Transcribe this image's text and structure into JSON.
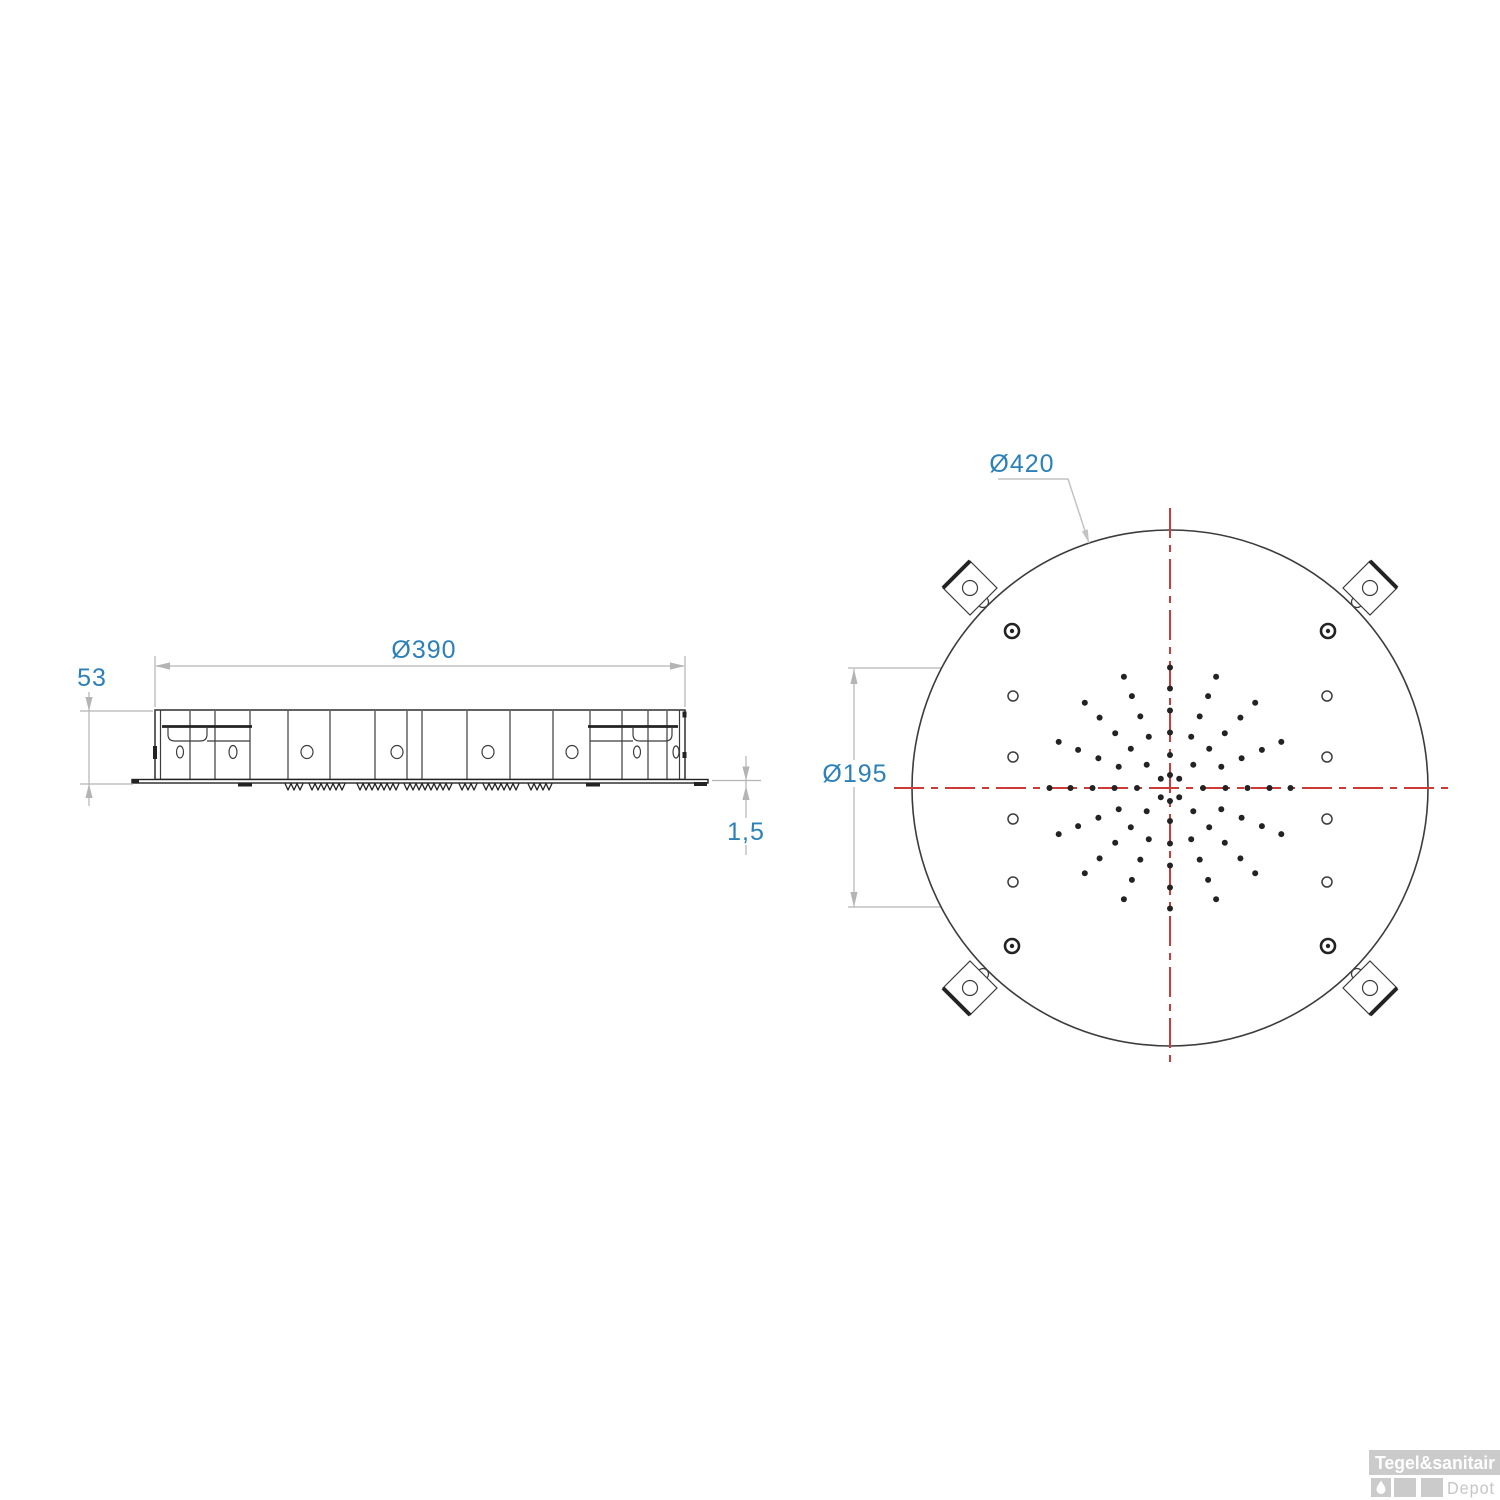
{
  "colors": {
    "drawing_line": "#3c3c3c",
    "drawing_line_heavy": "#232323",
    "dimension_line": "#b4b4b4",
    "dimension_text": "#2b80ba",
    "centerline_red": "#cc3b38",
    "watermark_gray": "#cbcbcb",
    "watermark_text_gray": "#c6c6c6",
    "background": "#ffffff"
  },
  "side_view": {
    "labels": {
      "width_dim": "Ø390",
      "height_dim": "53",
      "plate_dim": "1,5"
    },
    "dividers": [
      190,
      215,
      250,
      288,
      330,
      375,
      407,
      422,
      467,
      510,
      553,
      590,
      622,
      648,
      667
    ],
    "ovals": [
      [
        180,
        3.5,
        6
      ],
      [
        233,
        4,
        6.5
      ],
      [
        307,
        6,
        6.5
      ],
      [
        397,
        6,
        6.5
      ],
      [
        488,
        6,
        6.5
      ],
      [
        572,
        6,
        6.5
      ],
      [
        637,
        3.5,
        6
      ],
      [
        676,
        3,
        6
      ]
    ],
    "teeth_clusters": [
      [
        285,
        303
      ],
      [
        309,
        347
      ],
      [
        357,
        400
      ],
      [
        404,
        453
      ],
      [
        459,
        478
      ],
      [
        483,
        522
      ],
      [
        528,
        553
      ]
    ],
    "teeth": {
      "pitch": 6,
      "depth": 6.5
    }
  },
  "top_view": {
    "labels": {
      "outer_dim": "Ø420",
      "pattern_dim": "Ø195"
    },
    "center": {
      "x": 1170,
      "y": 788
    },
    "outer_radius": 258,
    "nozzle_dot_radius": 3,
    "nozzle_rings": [
      {
        "radius": 13,
        "angles": [
          45,
          90,
          135,
          225,
          270,
          315
        ]
      },
      {
        "radius": 33,
        "count": 8,
        "step": 45,
        "start": 0
      },
      {
        "radius": 55.5,
        "count": 16,
        "step": 22.5,
        "start": 0
      },
      {
        "radius": 77.5,
        "count": 16,
        "step": 22.5,
        "start": 0
      },
      {
        "radius": 99.5,
        "count": 16,
        "step": 22.5,
        "start": 0
      },
      {
        "radius": 120.5,
        "count": 16,
        "step": 22.5,
        "start": 0
      }
    ],
    "screw_holes": {
      "columns_x": [
        1013,
        1327
      ],
      "rows_y": [
        696,
        757,
        819,
        882
      ],
      "radius": 5
    },
    "corner_holes": {
      "positions": [
        [
          1012,
          631
        ],
        [
          1328,
          631
        ],
        [
          1012,
          946
        ],
        [
          1328,
          946
        ]
      ],
      "outer_radius": 7,
      "inner_radius": 2.2
    },
    "brackets": {
      "centers": [
        [
          970,
          588
        ],
        [
          1370,
          588
        ],
        [
          970,
          988
        ],
        [
          1370,
          988
        ]
      ],
      "half_diagonal": 27,
      "hole_radius": 7.5,
      "notch_radius": 5.5
    }
  },
  "watermark": {
    "brand": "Tegel&sanitair",
    "product_line": "Depot"
  }
}
